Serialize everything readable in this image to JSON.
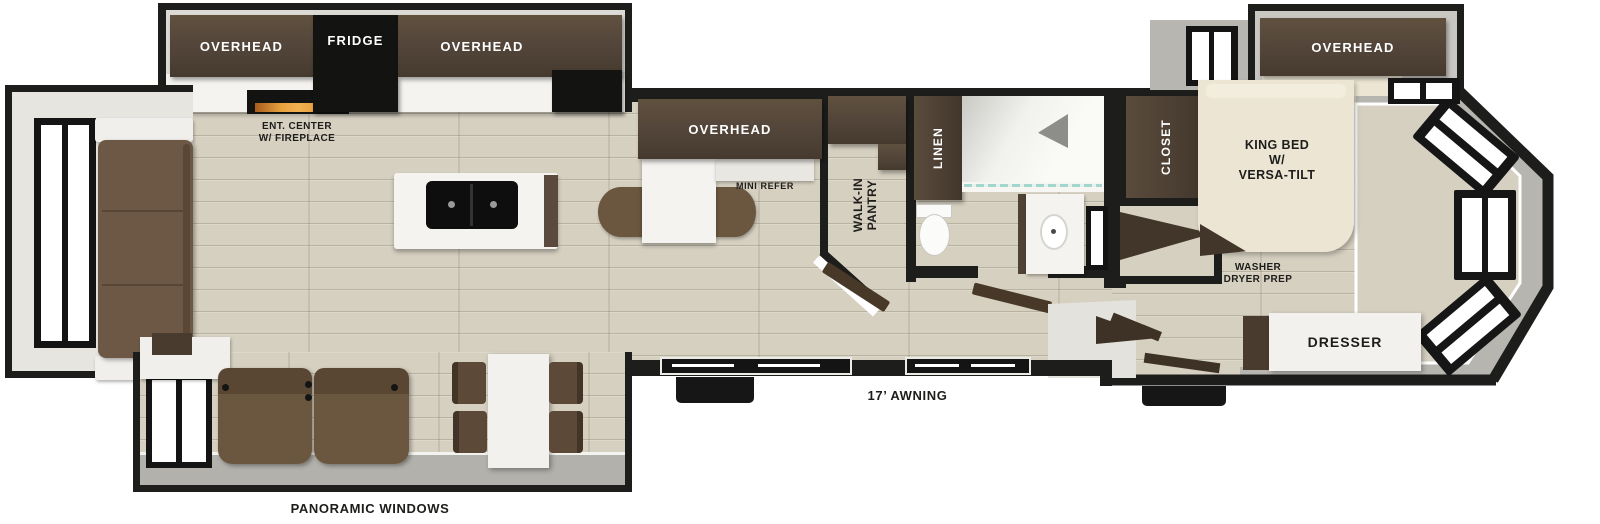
{
  "colors": {
    "wall": "#1d1d1b",
    "floor": "#d6d0c1",
    "cabinet": "#54463a",
    "counter": "#f4f3f0",
    "slide_gray": "#b7b5b0",
    "sofa_brown": "#6d5845",
    "bed_cream": "#ece5d3",
    "fireplace_flame": "#e0922f",
    "shower_glass": "#a5d6cd"
  },
  "plan": {
    "kitchen_slide": {
      "overhead_left": "OVERHEAD",
      "fridge": "FRIDGE",
      "overhead_right": "OVERHEAD"
    },
    "living": {
      "ent_center_1": "ENT. CENTER",
      "ent_center_2": "W/ FIREPLACE",
      "panoramic": "PANORAMIC WINDOWS"
    },
    "galley": {
      "overhead": "OVERHEAD",
      "mini_refer": "MINI REFER",
      "pantry_1": "WALK-IN",
      "pantry_2": "PANTRY"
    },
    "bath": {
      "linen": "LINEN"
    },
    "bedroom": {
      "closet": "CLOSET",
      "overhead": "OVERHEAD",
      "bed_1": "KING BED",
      "bed_2": "W/",
      "bed_3": "VERSA-TILT",
      "wd_1": "WASHER",
      "wd_2": "DRYER PREP",
      "dresser": "DRESSER"
    },
    "exterior": {
      "awning": "17’ AWNING"
    }
  }
}
